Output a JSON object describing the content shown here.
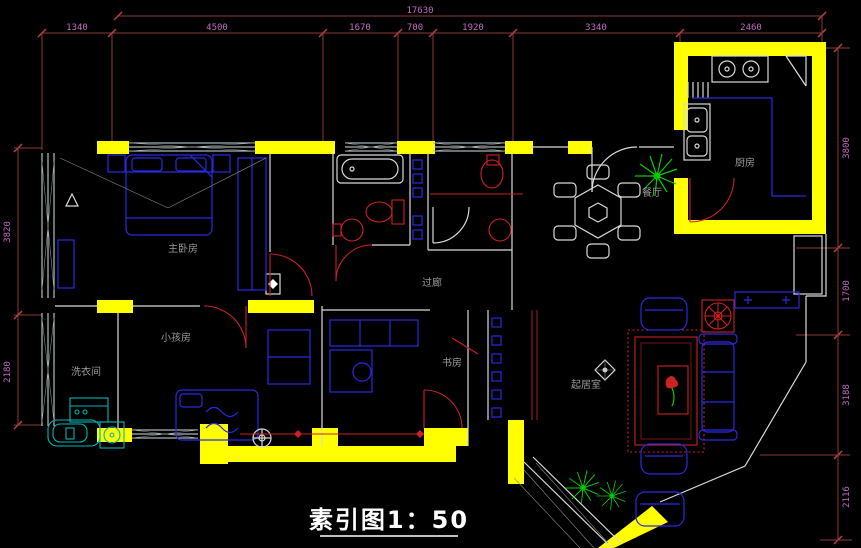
{
  "drawing": {
    "title_label": "素引图1：50"
  },
  "rooms": {
    "master_bedroom": "主卧房",
    "kids_room": "小孩房",
    "laundry": "洗衣间",
    "study": "书房",
    "corridor": "过廊",
    "living_room": "起居室",
    "dining_room": "餐厅",
    "kitchen": "厨房"
  },
  "dimensions": {
    "top_total": "17630",
    "top_chain": [
      "1340",
      "4500",
      "1670",
      "700",
      "1920",
      "3340",
      "2460"
    ],
    "left_chain": [
      "3820",
      "2180"
    ],
    "right_chain": [
      "3800",
      "1700",
      "3188",
      "2116"
    ]
  },
  "colors": {
    "background": "#000000",
    "wall_yellow": "#ffff00",
    "dimension_line": "#8b3a3a",
    "dimension_text": "#c468c4",
    "furniture_blue": "#2a2ae0",
    "fixture_red": "#cc2222",
    "plant_green": "#00cc00",
    "plumbing_cyan": "#00b7b7",
    "wall_line_white": "#d9d9d9",
    "label_gray": "#9a9a9a",
    "title_white": "#ffffff"
  }
}
